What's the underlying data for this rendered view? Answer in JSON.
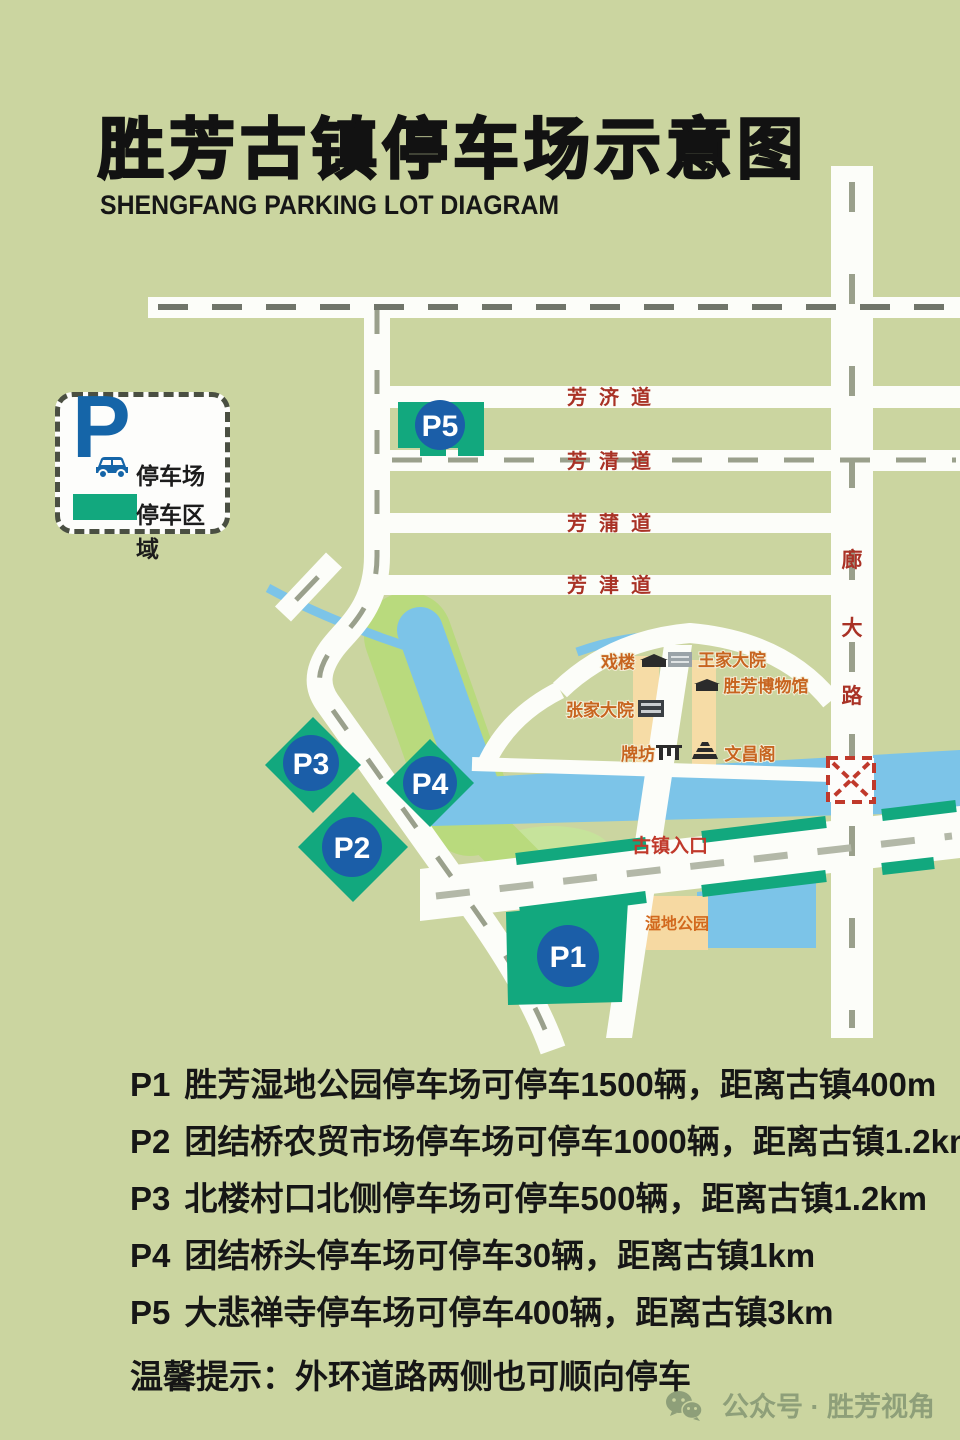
{
  "title": "胜芳古镇停车场示意图",
  "subtitle": "SHENGFANG PARKING LOT DIAGRAM",
  "legend": {
    "symbol": "P",
    "parking_lot": "停车场",
    "parking_area": "停车区域"
  },
  "map": {
    "roads": {
      "fangji": "芳济道",
      "fangqing": "芳清道",
      "fangpu": "芳蒲道",
      "fangjin": "芳津道",
      "langda_chars": [
        "廊",
        "大",
        "路"
      ]
    },
    "landmarks": {
      "xilou": "戏楼",
      "wangjia": "王家大院",
      "museum": "胜芳博物馆",
      "zhangjia": "张家大院",
      "paifang": "牌坊",
      "wenchang": "文昌阁",
      "entrance": "古镇入口",
      "wetland": "湿地公园"
    },
    "markers": [
      {
        "label": "P1"
      },
      {
        "label": "P2"
      },
      {
        "label": "P3"
      },
      {
        "label": "P4"
      },
      {
        "label": "P5"
      }
    ]
  },
  "notes": {
    "items": [
      {
        "code": "P1",
        "text": "胜芳湿地公园停车场可停车1500辆，距离古镇400m"
      },
      {
        "code": "P2",
        "text": "团结桥农贸市场停车场可停车1000辆，距离古镇1.2km"
      },
      {
        "code": "P3",
        "text": "北楼村口北侧停车场可停车500辆，距离古镇1.2km"
      },
      {
        "code": "P4",
        "text": "团结桥头停车场可停车30辆，距离古镇1km"
      },
      {
        "code": "P5",
        "text": "大悲禅寺停车场可停车400辆，距离古镇3km"
      }
    ],
    "tip": "温馨提示：外环道路两侧也可顺向停车"
  },
  "footer": {
    "label": "公众号 · 胜芳视角"
  },
  "colors": {
    "background": "#cbd5a0",
    "road": "#fcfdf9",
    "water": "#7cc4e8",
    "parking_green": "#12a87e",
    "marker_blue": "#1b5ea8",
    "road_label_red": "#a93226",
    "landmark_orange": "#c7641f",
    "legend_blue": "#1565a8"
  }
}
